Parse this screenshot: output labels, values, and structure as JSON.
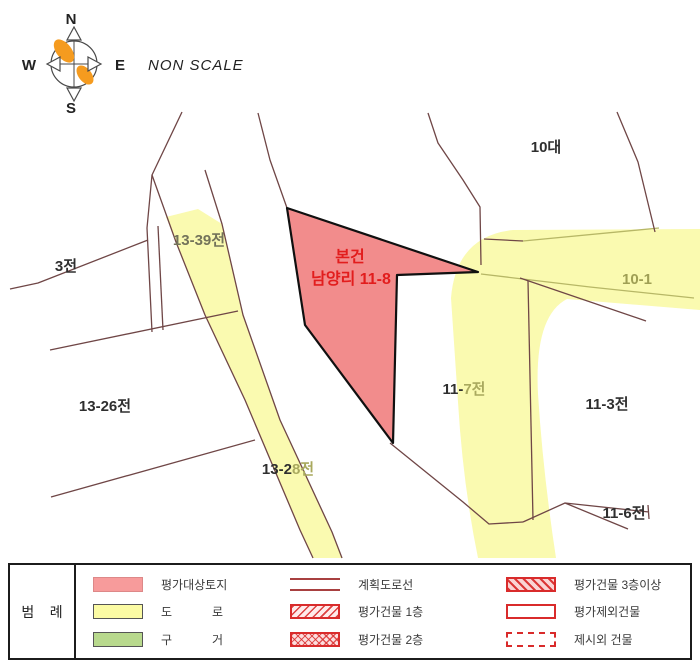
{
  "compass": {
    "north": "N",
    "south": "S",
    "west": "W",
    "east": "E"
  },
  "scale_note": "NON SCALE",
  "map": {
    "subject": {
      "line1": "본건",
      "line2": "남양리 11-8",
      "color": "#e21d1d"
    },
    "labels": [
      {
        "text": "10대",
        "color": "#2f2f2f"
      },
      {
        "text": "3전",
        "color": "#2f2f2f"
      },
      {
        "text": "13-39전",
        "color": "#73735a"
      },
      {
        "text": "13-26전",
        "color": "#2f2f2f"
      },
      {
        "part1": "13-2",
        "part2": "8전",
        "color1": "#2f2f2f",
        "color2": "#a9a95e"
      },
      {
        "part1": "11-",
        "part2": "7전",
        "color1": "#2f2f2f",
        "color2": "#a9a95e"
      },
      {
        "text": "11-3전",
        "color": "#2f2f2f"
      },
      {
        "text": "10-1",
        "color": "#9f9f54"
      },
      {
        "text": "11-6전",
        "color": "#2f2f2f"
      }
    ]
  },
  "legend": {
    "title": "범    례",
    "col1": [
      {
        "label": "평가대상토지"
      },
      {
        "label": "도            로"
      },
      {
        "label": "구            거"
      }
    ],
    "col2": [
      {
        "label": "계획도로선"
      },
      {
        "label": "평가건물 1층"
      },
      {
        "label": "평가건물 2층"
      }
    ],
    "col3": [
      {
        "label": "평가건물 3층이상"
      },
      {
        "label": "평가제외건물"
      },
      {
        "label": "제시외 건물"
      }
    ]
  },
  "colors": {
    "line-brown": "#6f4646",
    "road-yellow": "#fafab0",
    "road-edge": "#b7b766",
    "subject-fill": "#f28c8c",
    "subject-stroke": "#101010",
    "legend-red": "#d92b2b",
    "legend-pink": "#f79b9b",
    "legend-yellow": "#fbfba4",
    "legend-green": "#b8d98d",
    "legend-line-red": "#a84040",
    "compass-orange": "#f59b1f"
  }
}
